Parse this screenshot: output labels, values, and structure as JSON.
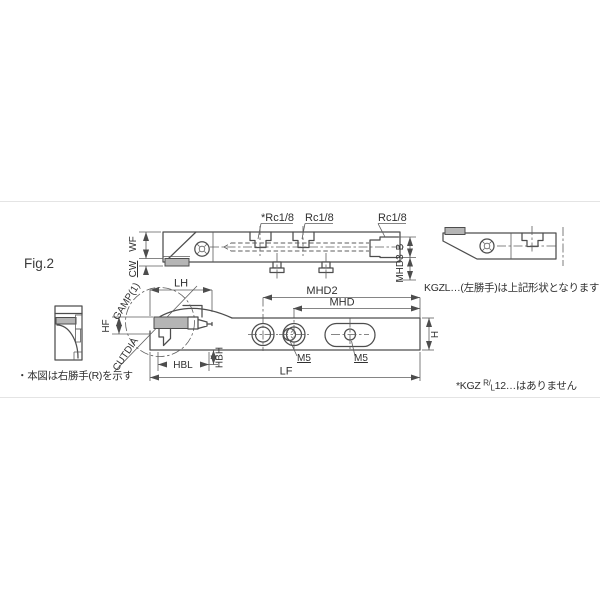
{
  "figure": {
    "label": "Fig.2"
  },
  "top_view": {
    "wf": "WF",
    "cw": "CW",
    "gamp": "GAMP(1)",
    "rc_port_1": "*Rc1/8",
    "rc_port_2": "Rc1/8",
    "rc_port_3": "Rc1/8",
    "b": "B",
    "mhd3": "MHD3"
  },
  "front_view": {
    "lh": "LH",
    "hf": "HF",
    "cutdia": "CUTDIA",
    "mhd2": "MHD2",
    "mhd": "MHD",
    "m5_left": "M5",
    "m5_right": "M5",
    "h": "H",
    "hbl": "HBL",
    "hbh": "HBH",
    "lf": "LF"
  },
  "notes": {
    "hand_note": "・本図は右勝手(R)を示す",
    "kgzl_note": "KGZL…(左勝手)は上記形状となります",
    "kgz12_pre": "*KGZ ",
    "kgz12_sup": "R/",
    "kgz12_sub": "L",
    "kgz12_suf": "12…はありません"
  },
  "colors": {
    "line": "#4d4d4d",
    "dim_line": "#5d5d5d",
    "text": "#303030",
    "insert_fill": "#b5b5b5",
    "page_rule": "#e4e4e4",
    "background": "#ffffff"
  }
}
